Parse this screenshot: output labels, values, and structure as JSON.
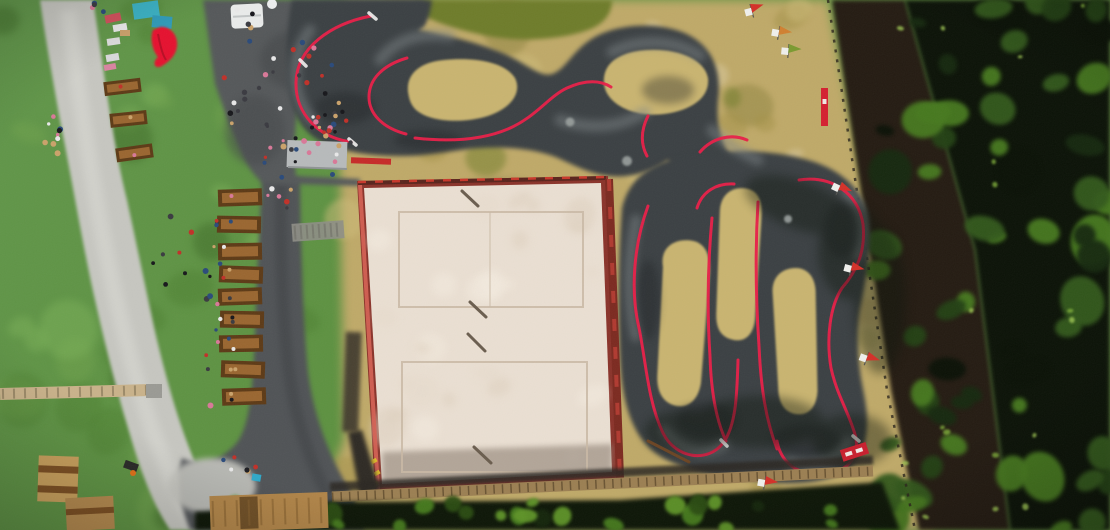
{
  "meta": {
    "title": "Aerial drone view of a pump track bike park",
    "description": "Top-down aerial photograph of an outdoor park: an asphalt pump track with red berm lines winding around dry grass islands, a large sand volleyball court with red borders, a gravel footpath, a row of wooden picnic tables with visitors, a crowd on an asphalt plaza, playground structures, a boardwalk, hedges and a dark forest with a dirt trail on the right."
  },
  "palette": {
    "grassBase": "#5d9140",
    "grassLight": "#79ab54",
    "grassDark": "#44702c",
    "dry": "#c3ae6c",
    "dryDark": "#8f8441",
    "dryLight": "#d9caa0",
    "olive": "#6e7c2a",
    "asphalt": "#3b4043",
    "asphaltLight": "#7e8587",
    "asphaltDark": "#191c1e",
    "plaza": "#55585a",
    "gravel": "#c6c6c0",
    "darkPath": "#505356",
    "sand": "#eadfd2",
    "sandShadow": "#8d7f72",
    "courtMaroon": "#7c2a20",
    "courtRed": "#b03a30",
    "courtPink": "#d66255",
    "trackRed": "#e81f48",
    "forest": "#0b1207",
    "dirtPath": "#241b12",
    "hedge": "#0d1607",
    "benchDark": "#5d3a16",
    "benchMid": "#9a6630",
    "boardwalk": "#9b7f52",
    "plankLine": "#5f4a2c",
    "wood": "#c9a05c",
    "woodDark": "#7c4f22",
    "tentWhite": "#e9ebea",
    "teal": "#3ab0c2",
    "canopyRed": "#e5112f",
    "flagRed": "#d42030",
    "stoneGray": "#9aa09e",
    "yellow": "#ddb92c"
  },
  "procedural": {
    "seed": 20240613,
    "grass_blotches": {
      "count": 34,
      "rmin": 10,
      "rmax": 30,
      "opacity": 0.5,
      "colors": [
        "#4e8032",
        "#6fa14c",
        "#7bb058",
        "#3f6b28"
      ]
    },
    "dry_blotches": {
      "count": 46,
      "rmin": 8,
      "rmax": 26,
      "opacity": 0.5,
      "colors": [
        "#8f8441",
        "#a39148",
        "#cdbb79",
        "#6f7c2a",
        "#d9caa0"
      ]
    },
    "sand_blotches": {
      "count": 26,
      "rmin": 6,
      "rmax": 18,
      "opacity": 0.5,
      "colors": [
        "#f4ece0",
        "#ddcfbd",
        "#e6dacb"
      ]
    },
    "forest_clumps": {
      "count": 62,
      "rmin": 7,
      "rmax": 22,
      "opacity": 0.95,
      "colors": [
        "#16290f",
        "#234114",
        "#33591c",
        "#47791f",
        "#0a1106"
      ]
    },
    "forest_highlights": {
      "count": 18,
      "rmin": 2,
      "rmax": 4,
      "opacity": 0.8,
      "colors": [
        "#7fae3a",
        "#9ec653"
      ]
    },
    "hedge_clumps": {
      "count": 26,
      "rmin": 5,
      "rmax": 12,
      "opacity": 0.95,
      "colors": [
        "#15260c",
        "#2b4c12",
        "#477c1e",
        "#5f9428"
      ]
    },
    "crowd_palette": [
      "#17171b",
      "#e8e8e8",
      "#c03028",
      "#2a4a7a",
      "#caa26a",
      "#3a3a40",
      "#d87898"
    ],
    "crowd_clusters": [
      {
        "cx": 285,
        "cy": 92,
        "rx": 62,
        "ry": 78,
        "count": 46
      },
      {
        "cx": 330,
        "cy": 140,
        "rx": 24,
        "ry": 36,
        "count": 12
      },
      {
        "cx": 276,
        "cy": 196,
        "rx": 16,
        "ry": 22,
        "count": 7
      },
      {
        "cx": 212,
        "cy": 300,
        "rx": 9,
        "ry": 108,
        "count": 16
      },
      {
        "cx": 52,
        "cy": 138,
        "rx": 13,
        "ry": 26,
        "count": 9
      },
      {
        "cx": 172,
        "cy": 240,
        "rx": 26,
        "ry": 55,
        "count": 7
      },
      {
        "cx": 238,
        "cy": 472,
        "rx": 26,
        "ry": 20,
        "count": 5
      },
      {
        "cx": 102,
        "cy": 6,
        "rx": 12,
        "ry": 6,
        "count": 4
      },
      {
        "cx": 248,
        "cy": 18,
        "rx": 16,
        "ry": 12,
        "count": 5
      }
    ]
  },
  "objects": {
    "picnic_tables": [
      {
        "x": 218,
        "y": 189,
        "rot": -2
      },
      {
        "x": 217,
        "y": 216,
        "rot": 1
      },
      {
        "x": 218,
        "y": 243,
        "rot": -1
      },
      {
        "x": 219,
        "y": 266,
        "rot": 2
      },
      {
        "x": 218,
        "y": 288,
        "rot": -2
      },
      {
        "x": 220,
        "y": 311,
        "rot": 1
      },
      {
        "x": 219,
        "y": 335,
        "rot": -1
      },
      {
        "x": 221,
        "y": 361,
        "rot": 2
      },
      {
        "x": 222,
        "y": 388,
        "rot": -2
      }
    ],
    "lawn_tables": [
      {
        "x": 104,
        "y": 80,
        "rot": -7
      },
      {
        "x": 110,
        "y": 112,
        "rot": -6
      },
      {
        "x": 116,
        "y": 146,
        "rot": -8
      }
    ],
    "towels": [
      {
        "x": 105,
        "y": 14,
        "w": 16,
        "h": 8,
        "rot": -12,
        "c": "#cf4f5a"
      },
      {
        "x": 113,
        "y": 24,
        "w": 14,
        "h": 7,
        "rot": -10,
        "c": "#e6e6e6"
      },
      {
        "x": 107,
        "y": 38,
        "w": 13,
        "h": 7,
        "rot": -8,
        "c": "#dcdcdc"
      },
      {
        "x": 120,
        "y": 30,
        "w": 10,
        "h": 6,
        "rot": 0,
        "c": "#caa06a"
      },
      {
        "x": 106,
        "y": 54,
        "w": 13,
        "h": 7,
        "rot": -10,
        "c": "#d8d8da"
      },
      {
        "x": 104,
        "y": 64,
        "w": 12,
        "h": 6,
        "rot": -10,
        "c": "#d884a0"
      }
    ],
    "pennant_flags": [
      {
        "x": 750,
        "y": 4,
        "rot": -15,
        "c": "#d43028"
      },
      {
        "x": 780,
        "y": 26,
        "rot": 10,
        "c": "#d08030"
      },
      {
        "x": 789,
        "y": 44,
        "rot": 5,
        "c": "#7a9a30"
      },
      {
        "x": 842,
        "y": 182,
        "rot": 25,
        "c": "#d43028"
      },
      {
        "x": 853,
        "y": 262,
        "rot": 15,
        "c": "#d43028"
      },
      {
        "x": 869,
        "y": 352,
        "rot": 20,
        "c": "#d43028"
      },
      {
        "x": 766,
        "y": 476,
        "rot": 10,
        "c": "#d43028"
      }
    ],
    "stones": [
      {
        "x": 570,
        "y": 122,
        "r": 4.5
      },
      {
        "x": 627,
        "y": 161,
        "r": 5
      },
      {
        "x": 788,
        "y": 219,
        "r": 4
      }
    ],
    "net_shadows": [
      {
        "x1": 462,
        "y1": 191,
        "x2": 478,
        "y2": 206
      },
      {
        "x1": 470,
        "y1": 302,
        "x2": 486,
        "y2": 317
      },
      {
        "x1": 468,
        "y1": 334,
        "x2": 485,
        "y2": 351
      },
      {
        "x1": 474,
        "y1": 447,
        "x2": 491,
        "y2": 463
      }
    ],
    "yellow_markers": [
      {
        "x": 371,
        "y": 459
      },
      {
        "x": 374,
        "y": 471
      },
      {
        "x": 372,
        "y": 482
      }
    ]
  }
}
